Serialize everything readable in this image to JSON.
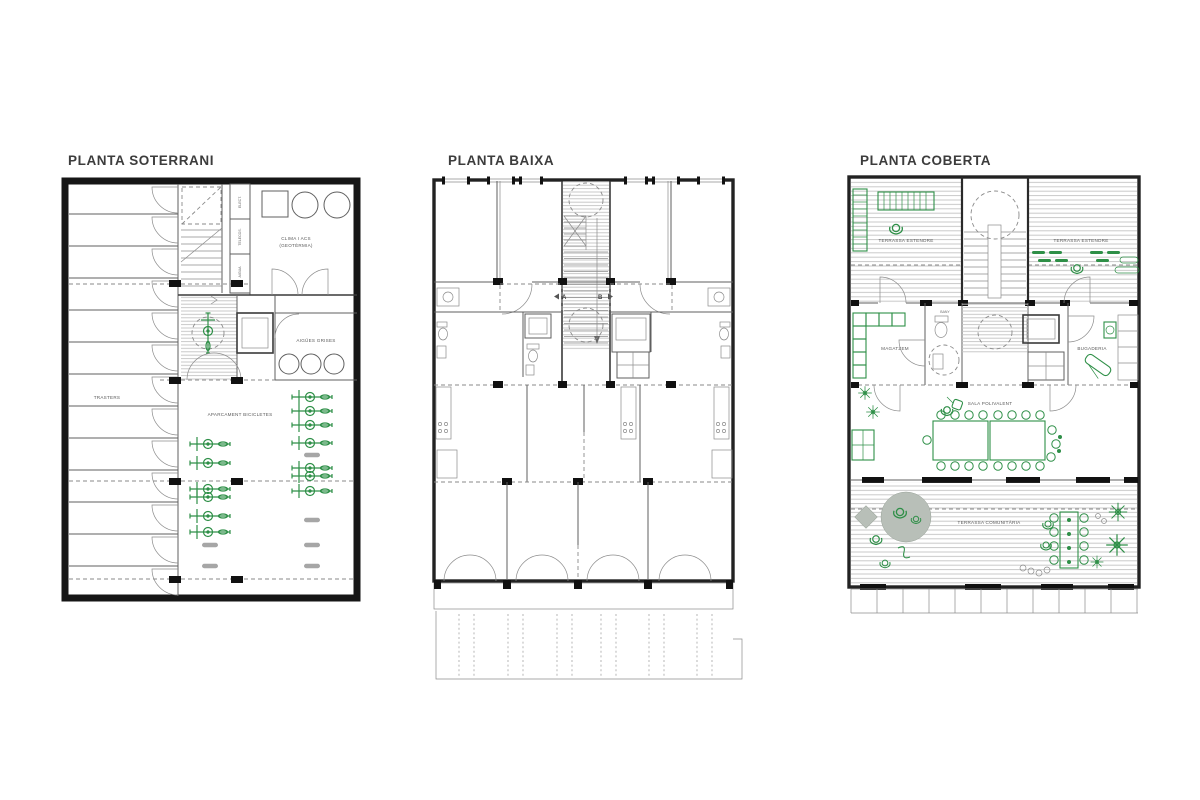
{
  "page": {
    "background": "#ffffff",
    "description": "Three architectural floor plans of a housing building"
  },
  "colors": {
    "green_accent": "#2e8f47",
    "wall_dark": "#1a1a1a",
    "hatch_gray": "#c9c9c9",
    "fill_gray": "#b8bfb8",
    "pill_gray": "#a6a6a6",
    "title_text": "#3c3c3c"
  },
  "plans": {
    "soterrani": {
      "title": "PLANTA SOTERRANI",
      "labels": {
        "clima_1": "CLIMA I ACS",
        "clima_2": "(GEOTÈRMIA)",
        "aigues_grises": "AIGÜES GRISES",
        "trasters": "TRASTERS",
        "aparcament": "APARCAMENT BICICLETES",
        "elect": "ELECT.",
        "telecos": "TELECOS.",
        "aigua": "AIGUA"
      }
    },
    "baixa": {
      "title": "PLANTA BAIXA",
      "labels": {
        "porta_a": "A",
        "porta_b": "B"
      }
    },
    "coberta": {
      "title": "PLANTA COBERTA",
      "labels": {
        "terrassa_estendre_esq": "TERRASSA ESTENDRE",
        "terrassa_estendre_dreta": "TERRASSA ESTENDRE",
        "magatzem": "MAGATZEM",
        "bany": "BANY",
        "bugaderia": "BUGADERIA",
        "sala_polivalent": "SALA POLIVALENT",
        "terrassa_comunitaria": "TERRASSA COMUNITÀRIA"
      }
    }
  }
}
